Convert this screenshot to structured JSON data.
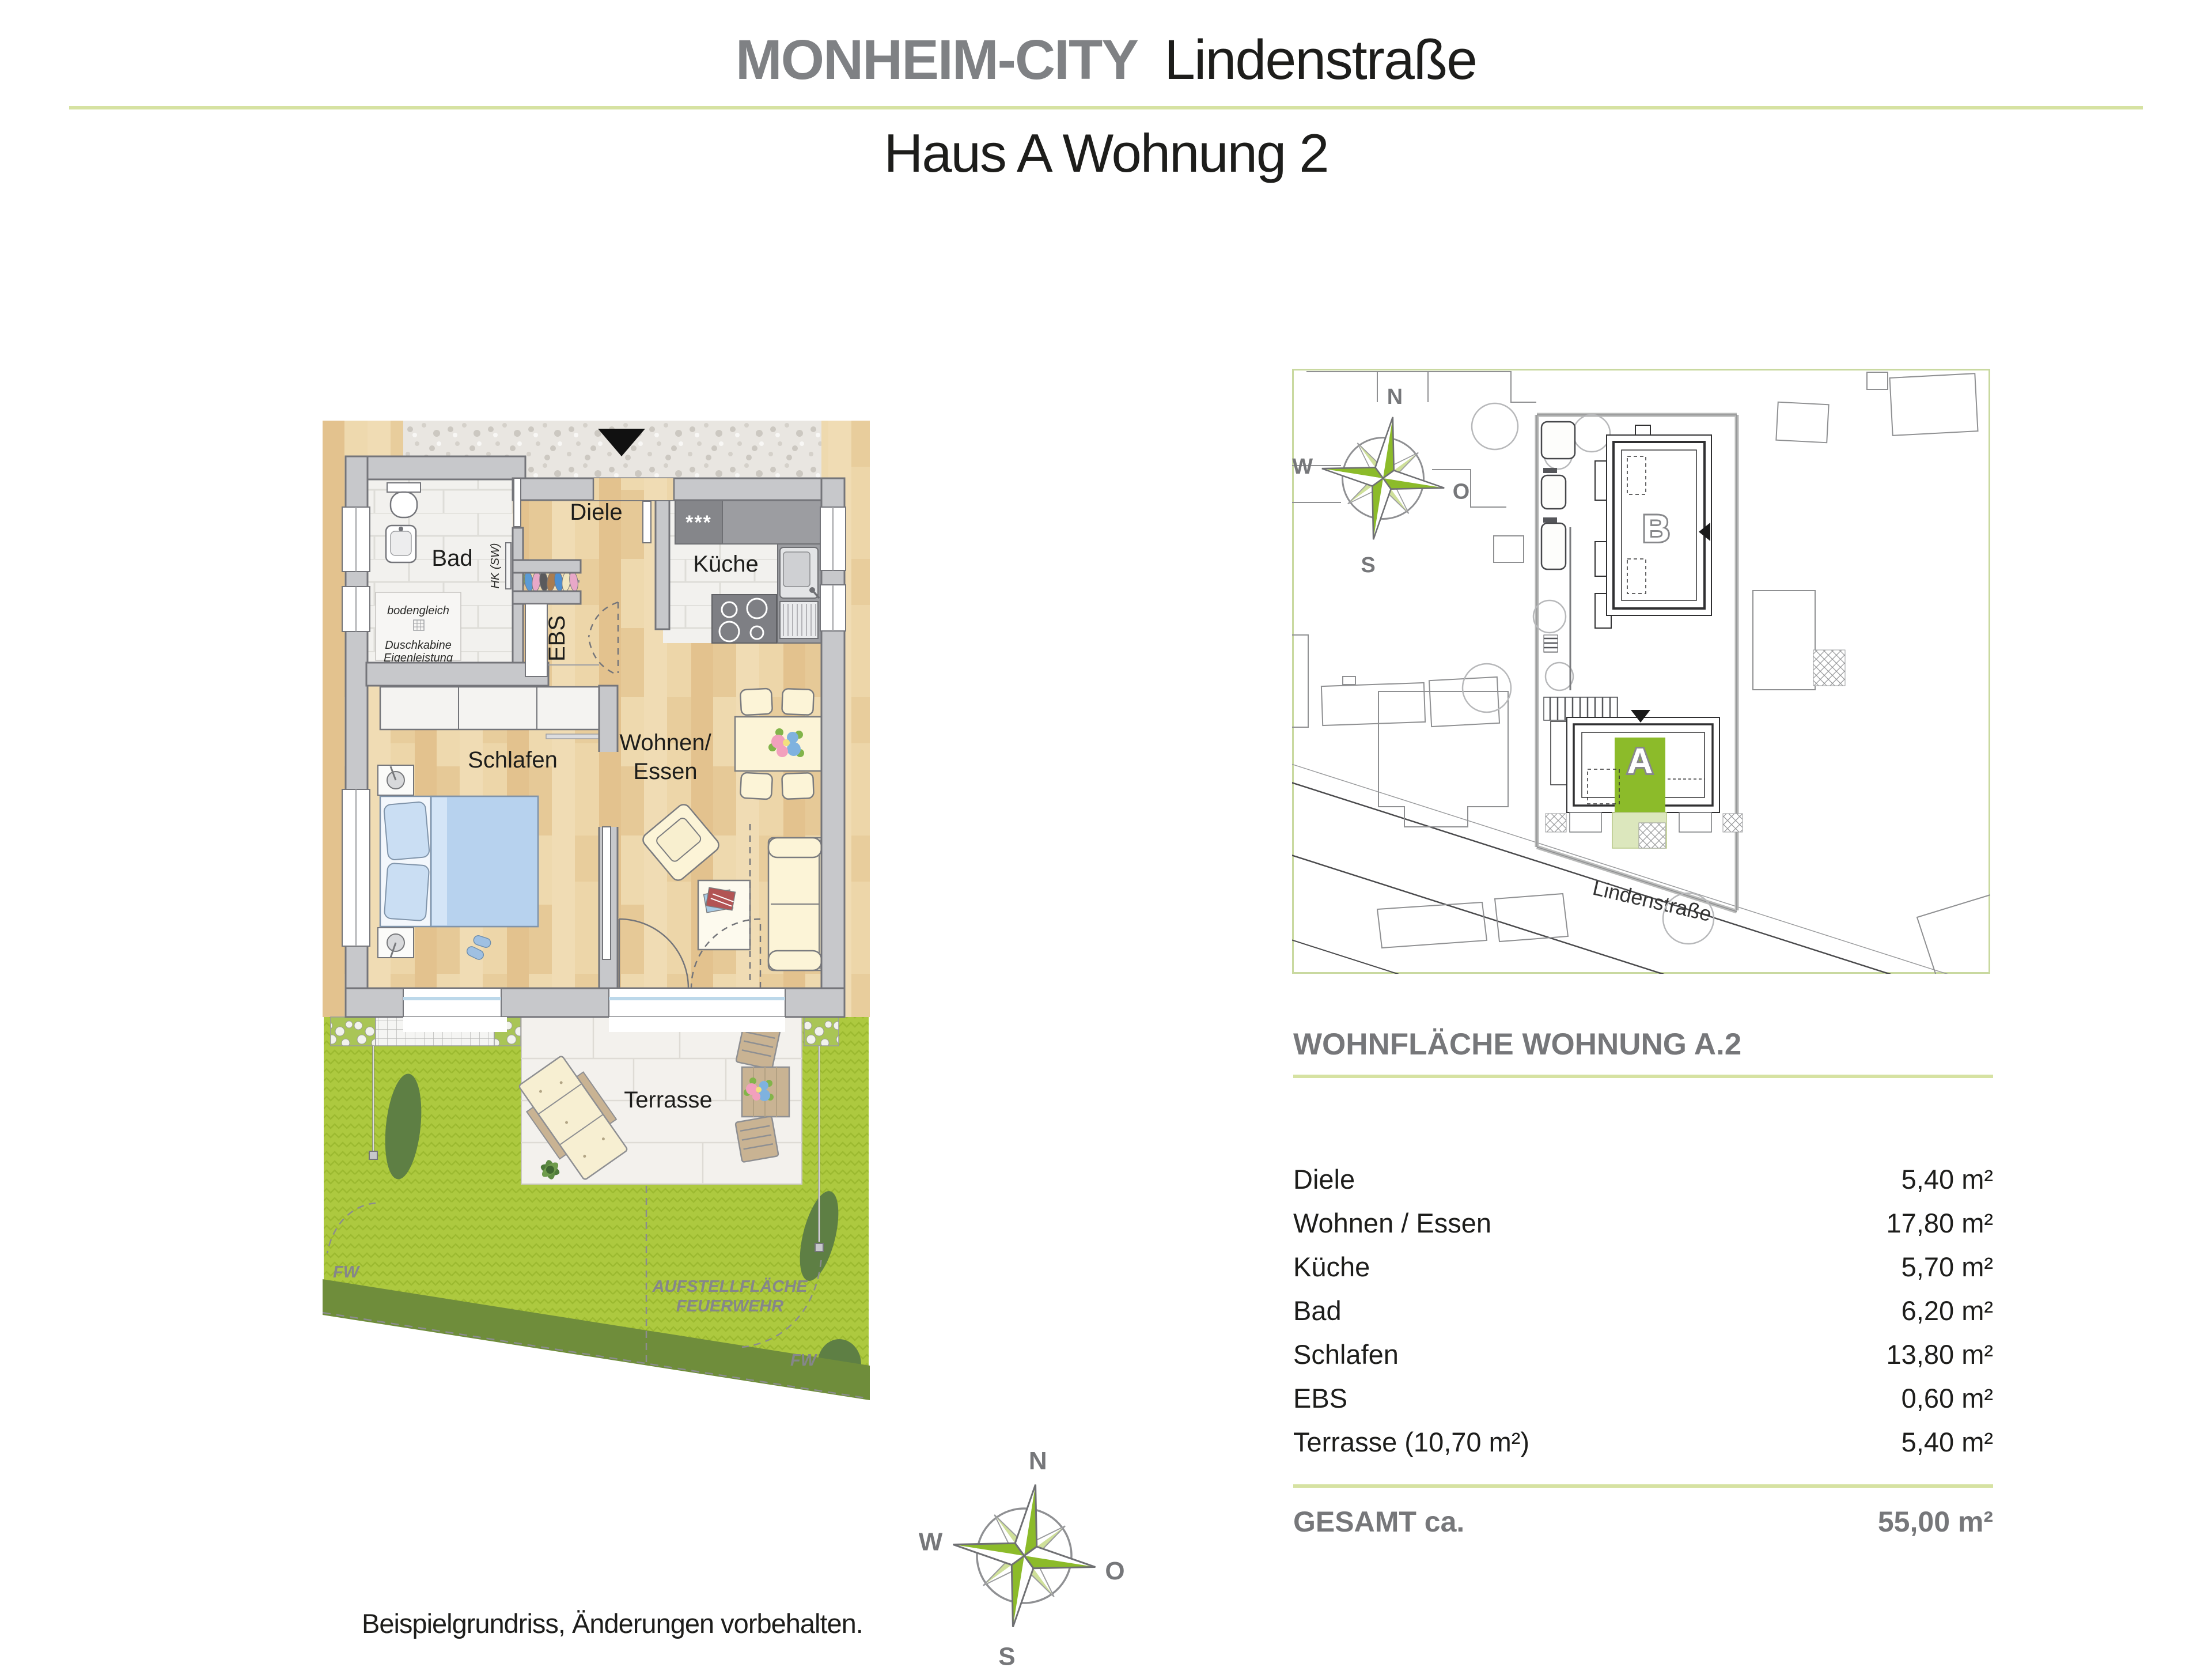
{
  "header": {
    "brand": "MONHEIM-CITY",
    "project": "Lindenstraße",
    "subtitle": "Haus A Wohnung 2"
  },
  "floorplan": {
    "rooms": {
      "diele": "Diele",
      "bad": "Bad",
      "kueche": "Küche",
      "ebs": "EBS",
      "schlafen": "Schlafen",
      "wohnen_line1": "Wohnen/",
      "wohnen_line2": "Essen",
      "terrasse": "Terrasse"
    },
    "annotations": {
      "bodengleich": "bodengleich",
      "duschkabine_line1": "Duschkabine",
      "duschkabine_line2": "Eigenleistung",
      "heizkoerper": "HK (SW)",
      "fridge_stars": "***",
      "feuerwehr_line1": "AUFSTELLFLÄCHE",
      "feuerwehr_line2": "FEUERWEHR",
      "fw_left": "FW",
      "fw_right": "FW"
    }
  },
  "siteplan": {
    "building_a_label": "A",
    "building_b_label": "B",
    "street_label": "Lindenstraße"
  },
  "compass": {
    "north": "N",
    "east": "O",
    "south": "S",
    "west": "W"
  },
  "area_table": {
    "title": "WOHNFLÄCHE WOHNUNG A.2",
    "rows": [
      {
        "label": "Diele",
        "value": "5,40 m²"
      },
      {
        "label": "Wohnen / Essen",
        "value": "17,80 m²"
      },
      {
        "label": "Küche",
        "value": "5,70 m²"
      },
      {
        "label": "Bad",
        "value": "6,20 m²"
      },
      {
        "label": "Schlafen",
        "value": "13,80 m²"
      },
      {
        "label": "EBS",
        "value": "0,60 m²"
      },
      {
        "label": "Terrasse (10,70 m²)",
        "value": "5,40 m²"
      }
    ],
    "total_label": "GESAMT ca.",
    "total_value": "55,00 m²"
  },
  "footer": {
    "disclaimer": "Beispielgrundriss, Änderungen vorbehalten."
  },
  "colors": {
    "accent_green": "#8cbb2a",
    "light_green_rule": "#d6e2a2",
    "text_gray": "#76777a",
    "lawn_green": "#adc93f",
    "wall_gray": "#c7c8cb",
    "wood_floor": "#e9cfa0"
  }
}
